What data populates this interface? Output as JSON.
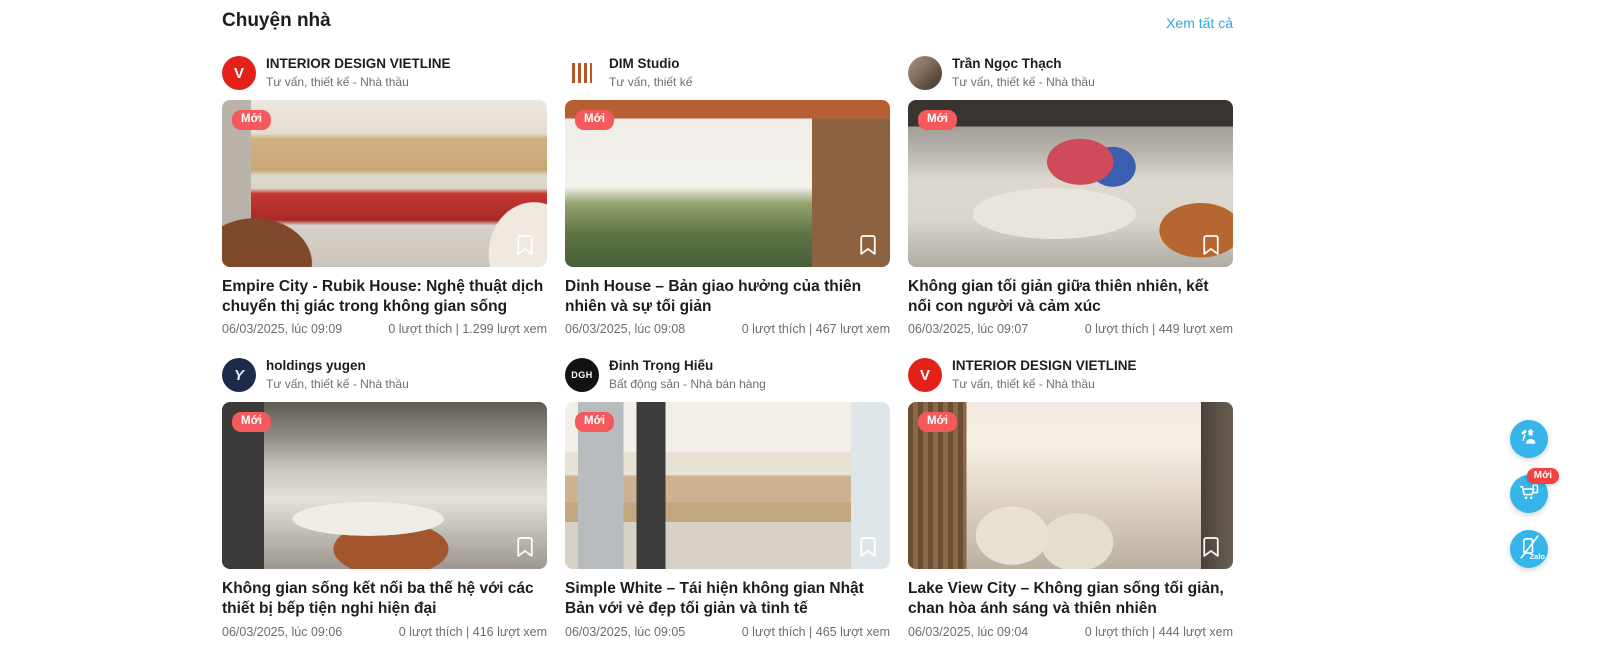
{
  "section": {
    "title": "Chuyện nhà",
    "view_all": "Xem tất cả"
  },
  "cards": [
    {
      "author_name": "INTERIOR DESIGN VIETLINE",
      "author_category": "Tư vấn, thiết kế - Nhà thầu",
      "avatar_text": "V",
      "badge": "Mới",
      "title": "Empire City - Rubik House: Nghệ thuật dịch chuyển thị giác trong không gian sống",
      "date": "06/03/2025, lúc 09:09",
      "stats": "0 lượt thích | 1.299 lượt xem"
    },
    {
      "author_name": "DIM Studio",
      "author_category": "Tư vấn, thiết kế",
      "avatar_text": "",
      "badge": "Mới",
      "title": "Dinh House – Bản giao hưởng của thiên nhiên và sự tối giản",
      "date": "06/03/2025, lúc 09:08",
      "stats": "0 lượt thích | 467 lượt xem"
    },
    {
      "author_name": "Trần Ngọc Thạch",
      "author_category": "Tư vấn, thiết kế - Nhà thầu",
      "avatar_text": "",
      "badge": "Mới",
      "title": "Không gian tối giản giữa thiên nhiên, kết nối con người và cảm xúc",
      "date": "06/03/2025, lúc 09:07",
      "stats": "0 lượt thích | 449 lượt xem"
    },
    {
      "author_name": "holdings yugen",
      "author_category": "Tư vấn, thiết kế - Nhà thầu",
      "avatar_text": "Y",
      "badge": "Mới",
      "title": "Không gian sống kết nối ba thế hệ với các thiết bị bếp tiện nghi hiện đại",
      "date": "06/03/2025, lúc 09:06",
      "stats": "0 lượt thích | 416 lượt xem"
    },
    {
      "author_name": "Đinh Trọng Hiếu",
      "author_category": "Bất động sản - Nhà bán hàng",
      "avatar_text": "DGH",
      "badge": "Mới",
      "title": "Simple White – Tái hiện không gian Nhật Bản với vẻ đẹp tối giản và tinh tế",
      "date": "06/03/2025, lúc 09:05",
      "stats": "0 lượt thích | 465 lượt xem"
    },
    {
      "author_name": "INTERIOR DESIGN VIETLINE",
      "author_category": "Tư vấn, thiết kế - Nhà thầu",
      "avatar_text": "V",
      "badge": "Mới",
      "title": "Lake View City – Không gian sống tối giản, chan hòa ánh sáng và thiên nhiên",
      "date": "06/03/2025, lúc 09:04",
      "stats": "0 lượt thích | 444 lượt xem"
    }
  ],
  "fab": {
    "store_badge": "Mới",
    "zalo_label": "Zalo",
    "icons": [
      "worker-icon",
      "cart-icon",
      "zalo-icon"
    ]
  },
  "colors": {
    "accent_blue": "#2ca9e1",
    "badge_red": "#f4595c",
    "fab_blue": "#35b5ea",
    "fab_badge_red": "#f04343",
    "avatar_red": "#e32119",
    "avatar_navy": "#1c2b4a",
    "avatar_black": "#121212"
  }
}
